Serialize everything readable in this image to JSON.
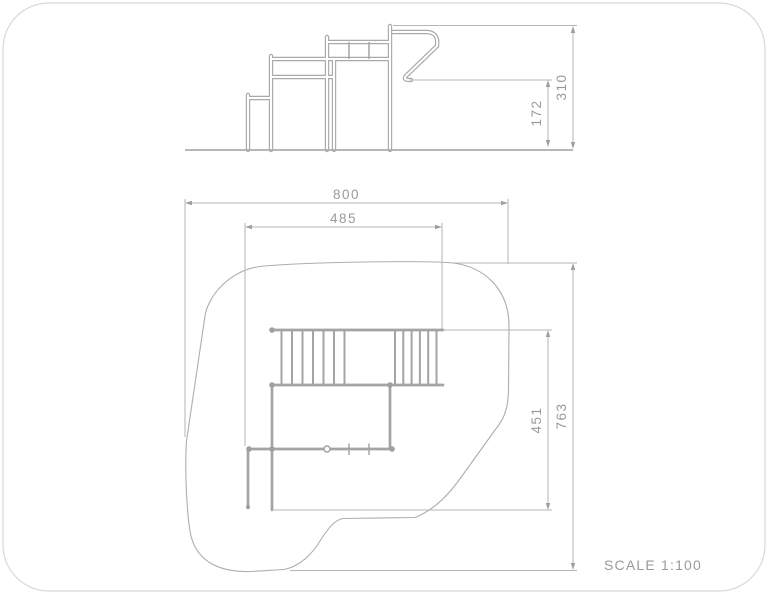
{
  "drawing": {
    "type": "playground-equipment-technical-drawing",
    "scale_label": "SCALE 1:100",
    "views": {
      "side_elevation": {
        "name": "side elevation",
        "dimensions": {
          "total_height": "310",
          "platform_height": "172"
        }
      },
      "plan": {
        "name": "plan view with safety zone",
        "dimensions": {
          "zone_width": "800",
          "structure_width": "485",
          "structure_depth": "451",
          "zone_depth": "763"
        }
      }
    },
    "colors": {
      "background": "#ffffff",
      "drawing_line": "#a4a4a4",
      "dimension_line": "#b6b6b6",
      "label_text": "#9a9a9a",
      "page_border": "#d8d8d8"
    }
  }
}
